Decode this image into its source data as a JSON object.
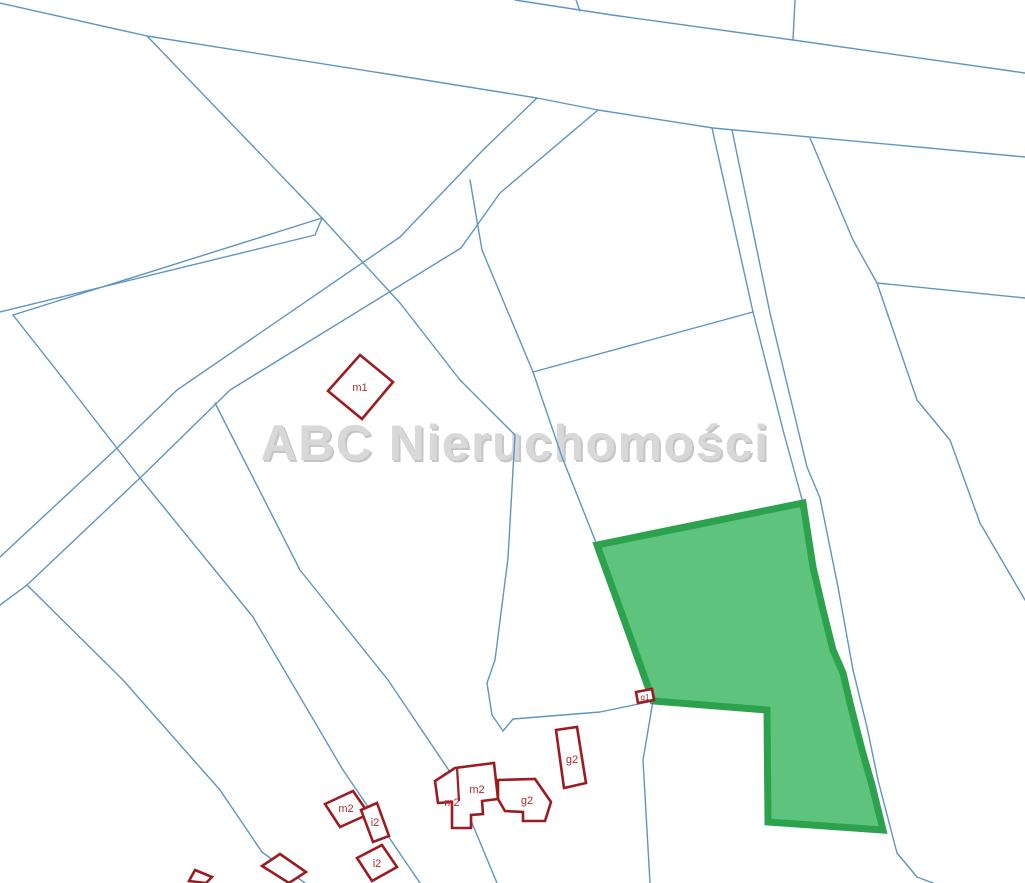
{
  "watermark": {
    "text": "ABC Nieruchomości"
  },
  "colors": {
    "background": "#ffffff",
    "line": "#5e95c2",
    "parcel_fill": "#5ec47d",
    "parcel_stroke": "#2da24e",
    "building_stroke": "#9d1c21",
    "building_label": "#b02a2c",
    "watermark": "#d8d8d8",
    "watermark_shadow": "#c6c6c6"
  },
  "map": {
    "buildings": [
      {
        "label": "m1"
      },
      {
        "label": "m2"
      },
      {
        "label": "i2"
      },
      {
        "label": "i2"
      },
      {
        "label": "m2"
      },
      {
        "label": "m2"
      },
      {
        "label": "g2"
      },
      {
        "label": "g2"
      },
      {
        "label": "g1"
      }
    ]
  }
}
